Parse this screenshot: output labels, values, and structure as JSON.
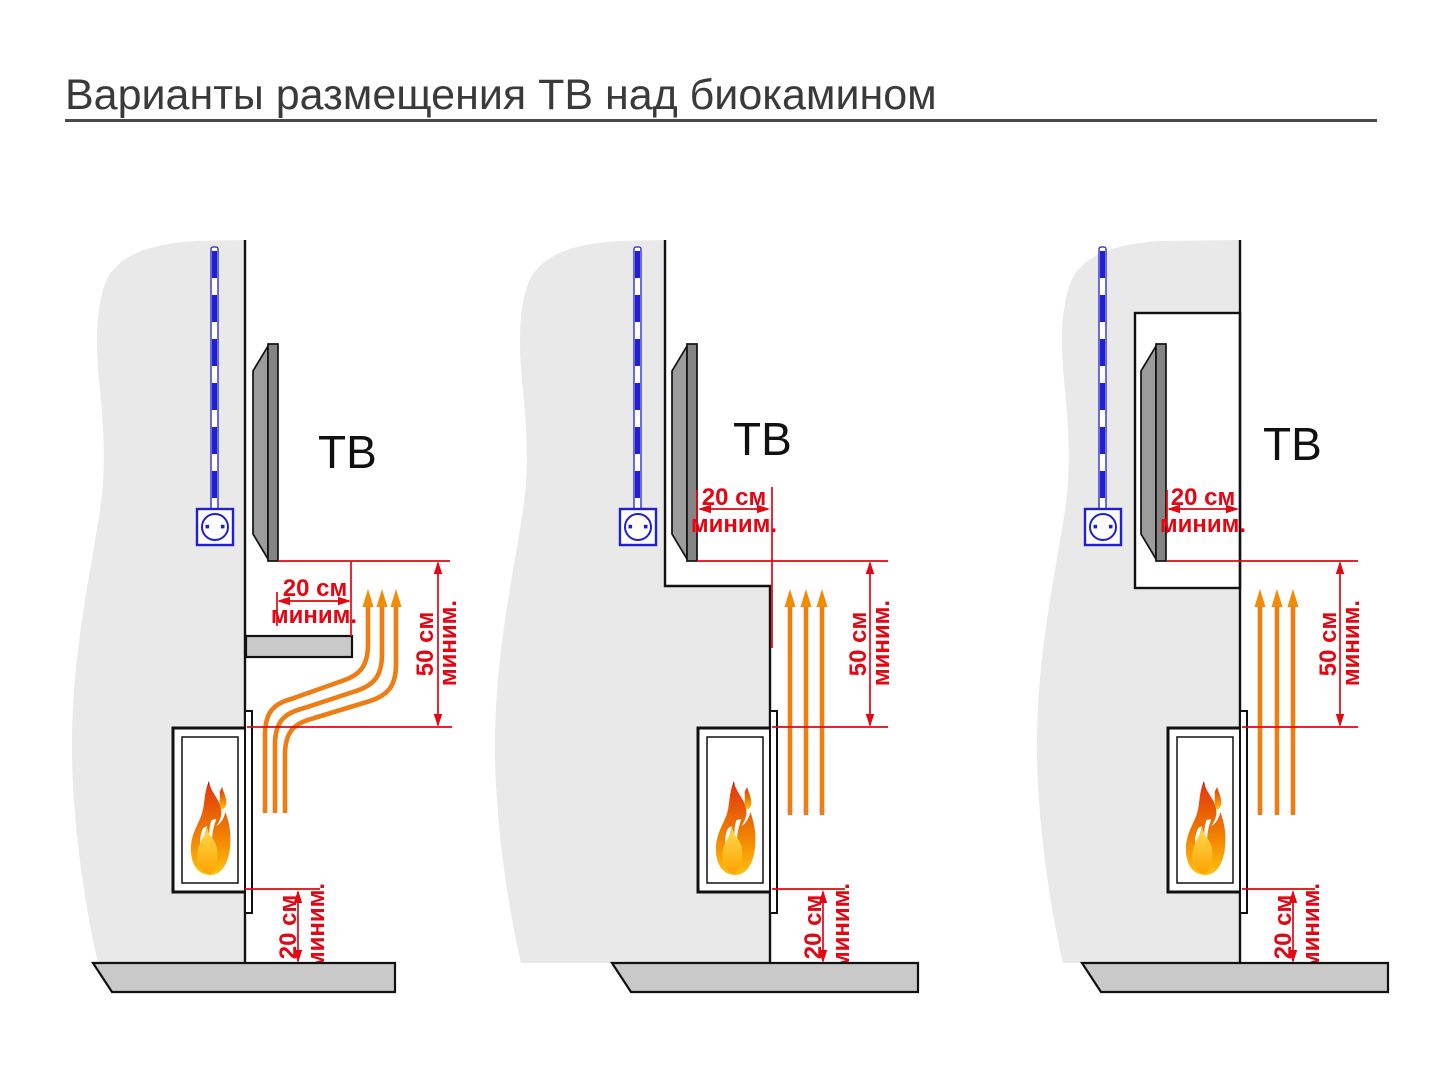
{
  "title": "Варианты размещения ТВ над биокамином",
  "colors": {
    "dimension_red": "#e30613",
    "heat_orange": "#ee7d14",
    "cable_blue": "#2020cf",
    "wall_gray": "#e9e9e9",
    "floor_gray": "#c9c9c9",
    "tv_gray": "#848484"
  },
  "diagrams": [
    {
      "tv_label": "ТВ",
      "side_clearance": {
        "value": "20 см",
        "qualifier": "миним."
      },
      "vertical_clearance": {
        "value": "50 см",
        "qualifier": "миним."
      },
      "floor_clearance": {
        "value": "20 см",
        "qualifier": "миним."
      }
    },
    {
      "tv_label": "ТВ",
      "side_clearance": {
        "value": "20 см",
        "qualifier": "миним."
      },
      "vertical_clearance": {
        "value": "50 см",
        "qualifier": "миним."
      },
      "floor_clearance": {
        "value": "20 см",
        "qualifier": "миним."
      }
    },
    {
      "tv_label": "ТВ",
      "side_clearance": {
        "value": "20 см",
        "qualifier": "миним."
      },
      "vertical_clearance": {
        "value": "50 см",
        "qualifier": "миним."
      },
      "floor_clearance": {
        "value": "20 см",
        "qualifier": "миним."
      }
    }
  ]
}
